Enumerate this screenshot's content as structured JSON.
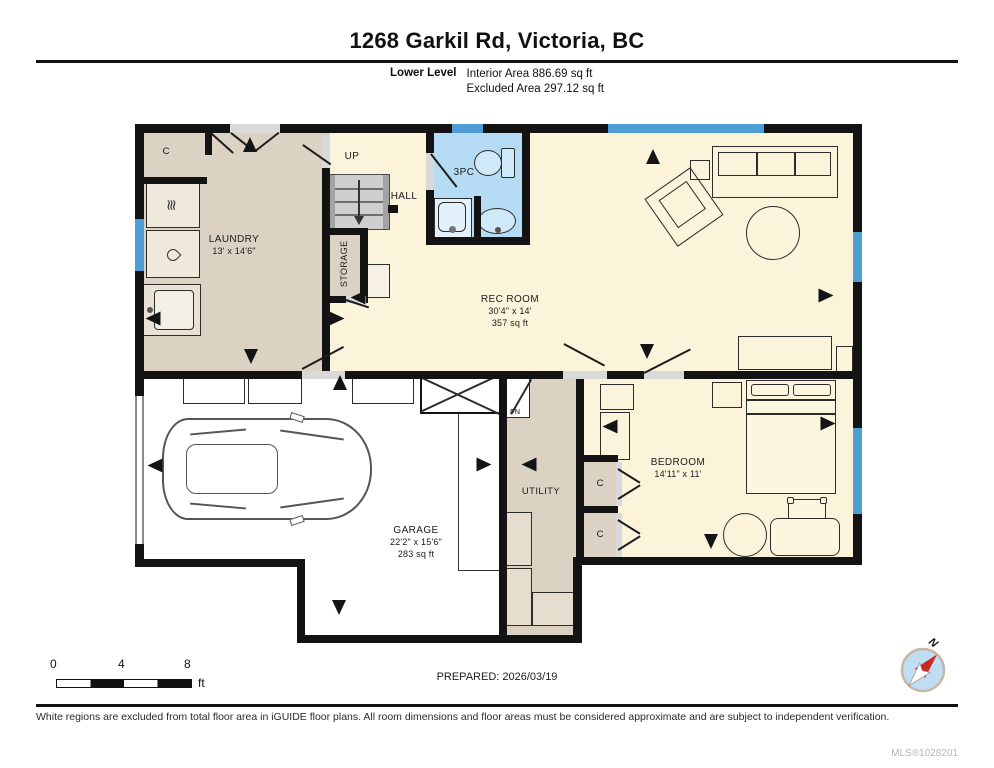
{
  "header": {
    "title": "1268 Garkil Rd, Victoria, BC",
    "level_label": "Lower Level",
    "interior_area": "Interior Area 886.69 sq ft",
    "excluded_area": "Excluded Area 297.12 sq ft"
  },
  "plan": {
    "rooms": {
      "laundry": {
        "name": "LAUNDRY",
        "dims": "13' x 14'6\""
      },
      "rec_room": {
        "name": "REC ROOM",
        "dims": "30'4\" x 14'",
        "area": "357 sq ft"
      },
      "garage": {
        "name": "GARAGE",
        "dims": "22'2\" x 15'6\"",
        "area": "283 sq ft"
      },
      "bedroom": {
        "name": "BEDROOM",
        "dims": "14'11\" x 11'"
      },
      "utility": {
        "name": "UTILITY"
      },
      "storage": {
        "name": "STORAGE"
      },
      "hall": {
        "name": "HALL"
      },
      "bathroom": {
        "name": "3PC"
      }
    },
    "labels": {
      "up": "UP",
      "closet": "C",
      "furnace": "FN"
    },
    "colors": {
      "wall": "#131313",
      "tan_room": "#DCD2C4",
      "yellow_room": "#FBF4DA",
      "bathroom_blue": "#B5DCF4",
      "window_blue": "#4E9ED6",
      "excluded_white": "#FFFFFF"
    }
  },
  "footer": {
    "scale_bar": {
      "tick_0": "0",
      "tick_4": "4",
      "tick_8": "8",
      "unit": "ft"
    },
    "prepared": "PREPARED: 2026/03/19",
    "compass_label": "N",
    "disclaimer": "White regions are excluded from total floor area in iGUIDE floor plans. All room dimensions and floor areas must be considered approximate and are subject to independent verification.",
    "mls": "MLS®1028201"
  }
}
